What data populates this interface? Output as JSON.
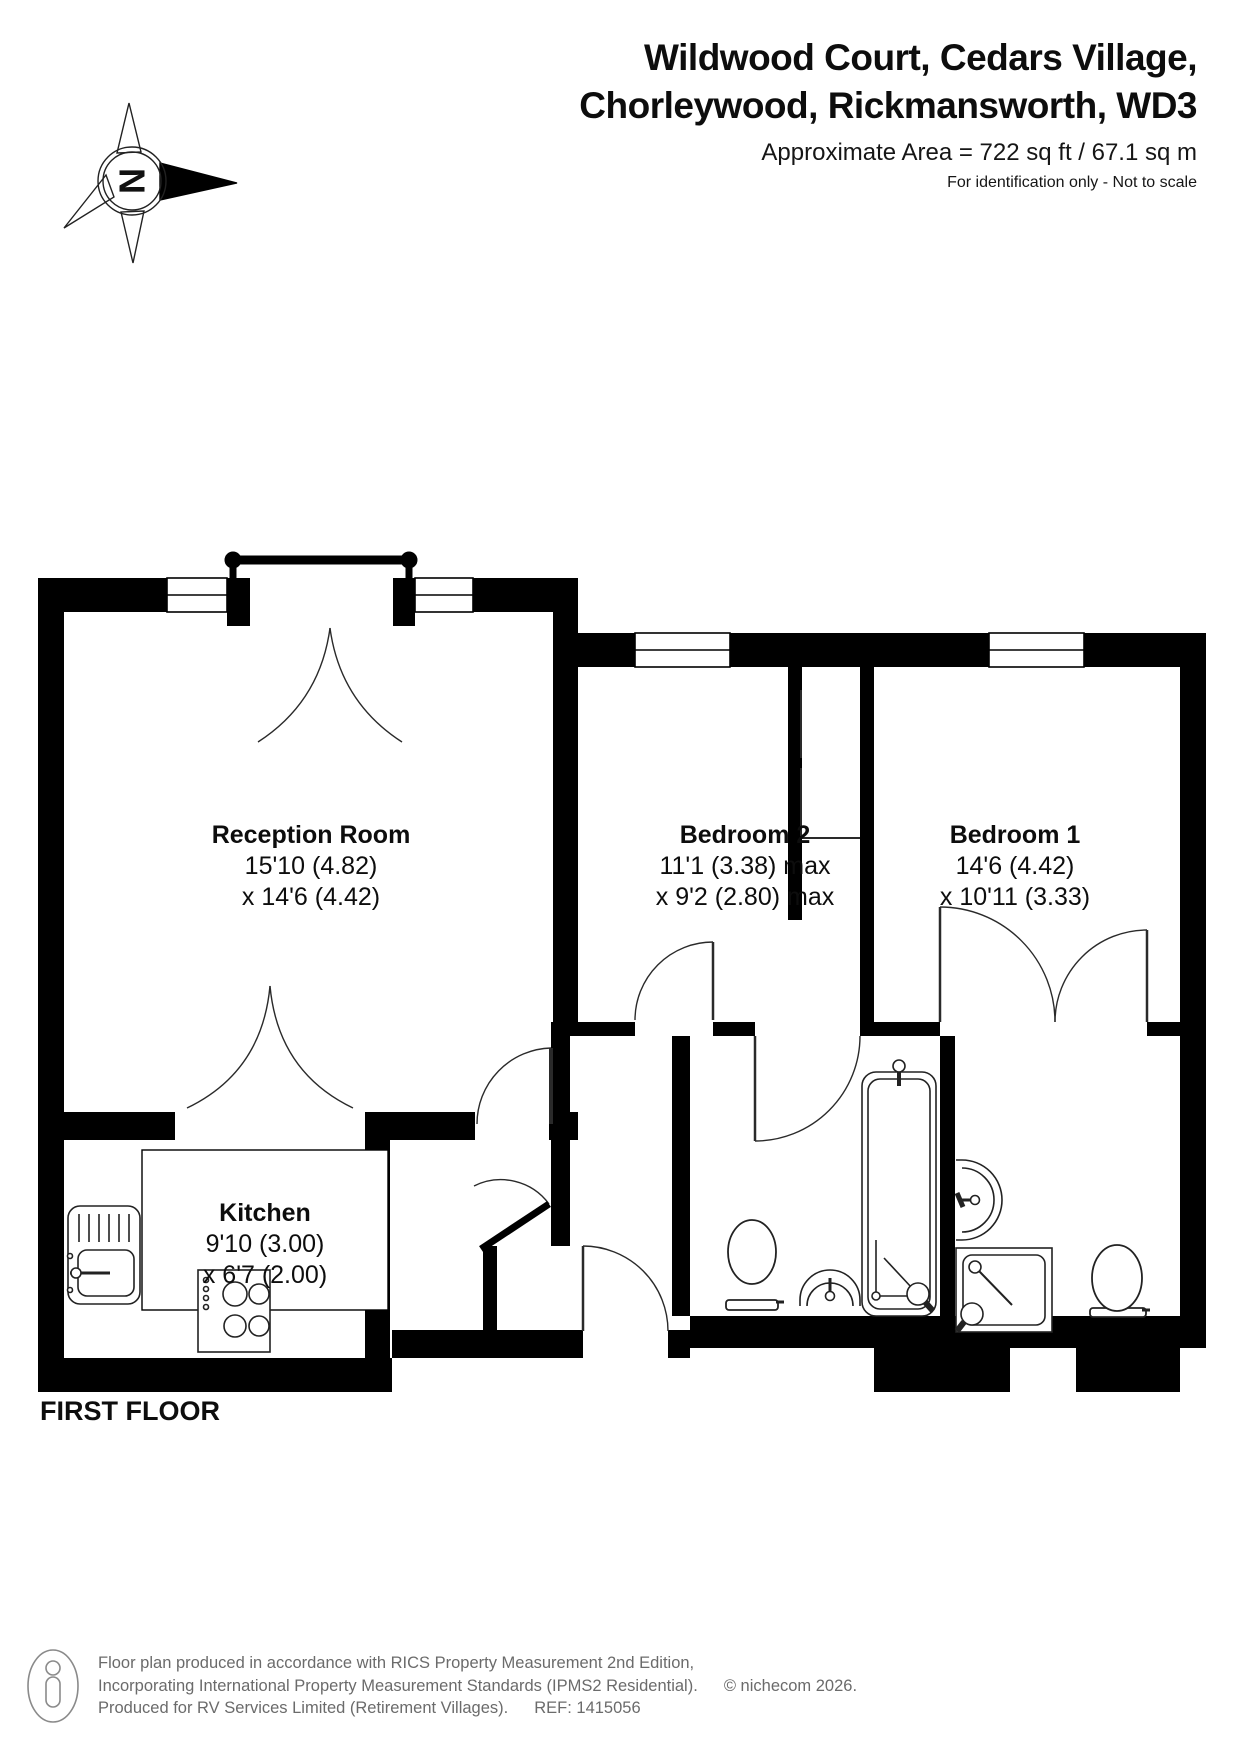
{
  "header": {
    "title_line1": "Wildwood Court, Cedars Village,",
    "title_line2": "Chorleywood, Rickmansworth, WD3",
    "area_text": "Approximate Area = 722 sq ft / 67.1 sq m",
    "disclaimer": "For identification only - Not to scale",
    "compass_letter": "N"
  },
  "floor_label": "FIRST FLOOR",
  "rooms": {
    "reception": {
      "name": "Reception Room",
      "dim1": "15'10 (4.82)",
      "dim2": "x 14'6 (4.42)"
    },
    "bedroom2": {
      "name": "Bedroom 2",
      "dim1": "11'1 (3.38) max",
      "dim2": "x 9'2 (2.80) max"
    },
    "bedroom1": {
      "name": "Bedroom 1",
      "dim1": "14'6 (4.42)",
      "dim2": "x 10'11 (3.33)"
    },
    "kitchen": {
      "name": "Kitchen",
      "dim1": "9'10 (3.00)",
      "dim2": "x 6'7 (2.00)"
    }
  },
  "fixtures": [
    "compass-north-icon",
    "kitchen-sink",
    "hob",
    "toilet",
    "hand-basin",
    "bathtub",
    "shower",
    "person-icon"
  ],
  "footer": {
    "line1": "Floor plan produced in accordance with RICS Property Measurement 2nd Edition,",
    "line2": "Incorporating International Property Measurement Standards (IPMS2 Residential).",
    "line2_suffix": "© nichecom 2026.",
    "line3": "Produced for RV Services Limited (Retirement Villages).",
    "line3_suffix": "REF: 1415056"
  },
  "colors": {
    "wall": "#000000",
    "text": "#0d0d0d",
    "footer_text": "#6b6b6b",
    "background": "#ffffff"
  }
}
